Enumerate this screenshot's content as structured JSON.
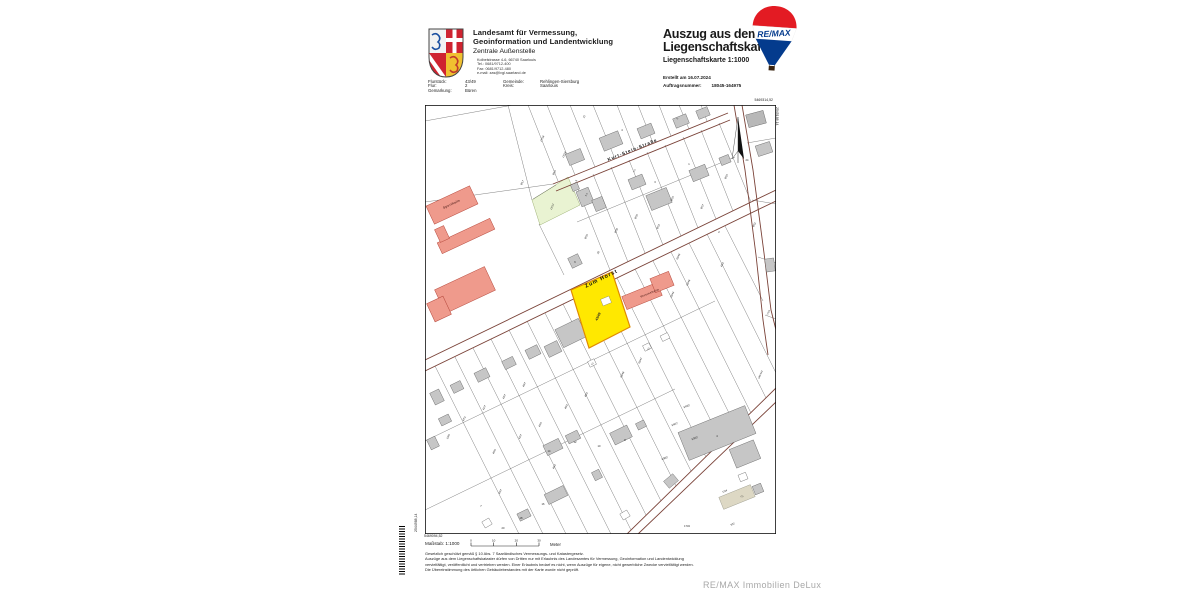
{
  "document": {
    "agency": {
      "name_line1": "Landesamt für Vermessung,",
      "name_line2": "Geoinformation und Landentwicklung",
      "office": "Zentrale Außenstelle",
      "address_lines": [
        "Kolbelstrasse 4-6, 66740 Saarlouis",
        "Tel.: 0681/9712-400",
        "Fax: 0681/9712-480",
        "e-mail: zas@lvgl.saarland.de"
      ]
    },
    "parcel_info": {
      "flurstueck_label": "Flurstück:",
      "flurstueck": "43/49",
      "flur_label": "Flur:",
      "flur": "2",
      "gemarkung_label": "Gemarkung:",
      "gemarkung": "Büren",
      "gemeinde_label": "Gemeinde:",
      "gemeinde": "Rehlingen-Siersburg",
      "kreis_label": "Kreis:",
      "kreis": "Saarlouis"
    },
    "title": {
      "line1": "Auszug aus dem",
      "line2": "Liegenschaftskataster",
      "subtitle": "Liegenschaftskarte  1:1000",
      "created": "Erstellt am  16.07.2024",
      "order_label": "Auftragsnummer:",
      "order_number": "18045-164975"
    },
    "logo": {
      "brand": "RE/MAX",
      "red": "#e31b23",
      "blue": "#043b8d"
    }
  },
  "map": {
    "corner_coordinates": {
      "north_top": "5469314,52",
      "east_right": "2545188,14",
      "west_left": "2544988,14",
      "north_bottom": "5469094,52"
    },
    "street_labels": [
      {
        "t": "Kurt-Stein-Straße",
        "x": 208,
        "y": 46,
        "r": -22,
        "s": 4.4
      },
      {
        "t": "Zum Horst",
        "x": 177,
        "y": 175,
        "r": -26,
        "s": 5.4
      }
    ],
    "area_labels": [
      {
        "t": "Sporthalle",
        "x": 27,
        "y": 100,
        "r": -25,
        "s": 3.2
      },
      {
        "t": "Vereinsheim",
        "x": 225,
        "y": 189,
        "r": -22,
        "s": 2.9
      }
    ],
    "subject_parcel": {
      "t": "43/49",
      "x": 174,
      "y": 212,
      "r": -65,
      "s": 3.4
    },
    "parcel_labels": [
      {
        "t": "17/18",
        "x": 118,
        "y": 34,
        "r": -65
      },
      {
        "t": "12/18",
        "x": 140,
        "y": 50,
        "r": -65
      },
      {
        "t": "8/19",
        "x": 130,
        "y": 68,
        "r": -65
      },
      {
        "t": "22",
        "x": 160,
        "y": 12,
        "r": -65
      },
      {
        "t": "4",
        "x": 197,
        "y": 26,
        "r": 0
      },
      {
        "t": "2",
        "x": 253,
        "y": 14,
        "r": -65
      },
      {
        "t": "6",
        "x": 152,
        "y": 76,
        "r": -65
      },
      {
        "t": "8/17",
        "x": 98,
        "y": 78,
        "r": -65
      },
      {
        "t": "12/17",
        "x": 128,
        "y": 102,
        "r": -65
      },
      {
        "t": "5 a",
        "x": 162,
        "y": 90,
        "r": -65,
        "s": 2.3
      },
      {
        "t": "1 b",
        "x": 210,
        "y": 66,
        "r": -65,
        "s": 2.3
      },
      {
        "t": "3",
        "x": 230,
        "y": 78,
        "r": 0
      },
      {
        "t": "1",
        "x": 264,
        "y": 60,
        "r": 0
      },
      {
        "t": "8/24",
        "x": 248,
        "y": 94,
        "r": -65
      },
      {
        "t": "8/34",
        "x": 302,
        "y": 72,
        "r": -65
      },
      {
        "t": "8/20",
        "x": 212,
        "y": 112,
        "r": -65
      },
      {
        "t": "8/28",
        "x": 192,
        "y": 126,
        "r": -65
      },
      {
        "t": "8/23",
        "x": 234,
        "y": 122,
        "r": -65
      },
      {
        "t": "8/27",
        "x": 278,
        "y": 102,
        "r": -65
      },
      {
        "t": "2",
        "x": 294,
        "y": 128,
        "r": 0
      },
      {
        "t": "8/29",
        "x": 162,
        "y": 132,
        "r": -65
      },
      {
        "t": "28",
        "x": 174,
        "y": 148,
        "r": -65
      },
      {
        "t": "6",
        "x": 150,
        "y": 158,
        "r": 0
      },
      {
        "t": "43/45",
        "x": 254,
        "y": 152,
        "r": -65
      },
      {
        "t": "43/46",
        "x": 264,
        "y": 178,
        "r": -65
      },
      {
        "t": "43/44",
        "x": 248,
        "y": 190,
        "r": -65
      },
      {
        "t": "43/2",
        "x": 298,
        "y": 160,
        "r": -65
      },
      {
        "t": "(1)",
        "x": 168,
        "y": 259,
        "r": -65,
        "s": 2.2
      },
      {
        "t": "(1)",
        "x": 224,
        "y": 244,
        "r": -65,
        "s": 2.2
      },
      {
        "t": "43/47",
        "x": 216,
        "y": 256,
        "r": -65
      },
      {
        "t": "43/48",
        "x": 198,
        "y": 270,
        "r": -65
      },
      {
        "t": "45/7",
        "x": 100,
        "y": 280,
        "r": -65
      },
      {
        "t": "43/7",
        "x": 80,
        "y": 292,
        "r": -65
      },
      {
        "t": "41/7",
        "x": 60,
        "y": 303,
        "r": -65
      },
      {
        "t": "47/1",
        "x": 40,
        "y": 314,
        "r": -65
      },
      {
        "t": "15/9",
        "x": 24,
        "y": 332,
        "r": -65
      },
      {
        "t": "44/4",
        "x": 116,
        "y": 320,
        "r": -65
      },
      {
        "t": "42/7",
        "x": 96,
        "y": 332,
        "r": -65
      },
      {
        "t": "40/9",
        "x": 70,
        "y": 347,
        "r": -65
      },
      {
        "t": "46/2",
        "x": 142,
        "y": 302,
        "r": -65
      },
      {
        "t": "48/2",
        "x": 162,
        "y": 290,
        "r": -65
      },
      {
        "t": "49/2",
        "x": 130,
        "y": 362,
        "r": -65
      },
      {
        "t": "44/7",
        "x": 76,
        "y": 387,
        "r": -65
      },
      {
        "t": "7",
        "x": 56,
        "y": 402,
        "r": 0
      },
      {
        "t": "10",
        "x": 174,
        "y": 342,
        "r": 0
      },
      {
        "t": "8",
        "x": 200,
        "y": 336,
        "r": 0
      },
      {
        "t": "14",
        "x": 124,
        "y": 347,
        "r": 0
      },
      {
        "t": "12",
        "x": 150,
        "y": 338,
        "r": 0
      },
      {
        "t": "16",
        "x": 118,
        "y": 400,
        "r": 0
      },
      {
        "t": "18",
        "x": 96,
        "y": 414,
        "r": 0
      },
      {
        "t": "20",
        "x": 78,
        "y": 424,
        "r": 0
      },
      {
        "t": "543/2",
        "x": 262,
        "y": 302,
        "r": -22
      },
      {
        "t": "540/7",
        "x": 250,
        "y": 320,
        "r": -22
      },
      {
        "t": "539/2",
        "x": 270,
        "y": 334,
        "r": -22
      },
      {
        "t": "538/2",
        "x": 240,
        "y": 354,
        "r": -22
      },
      {
        "t": "1001/542",
        "x": 336,
        "y": 270,
        "r": -65,
        "s": 2.2
      },
      {
        "t": "4",
        "x": 292,
        "y": 332,
        "r": 0
      },
      {
        "t": "1/34",
        "x": 300,
        "y": 387,
        "r": -22
      },
      {
        "t": "(1)",
        "x": 317,
        "y": 392,
        "r": 0,
        "s": 2.2
      },
      {
        "t": "537",
        "x": 308,
        "y": 420,
        "r": -22
      },
      {
        "t": "1734",
        "x": 262,
        "y": 422,
        "r": 0
      },
      {
        "t": "173/3",
        "x": 344,
        "y": 208,
        "r": -65,
        "s": 2.2
      },
      {
        "t": "8/31",
        "x": 330,
        "y": 120,
        "r": -65
      },
      {
        "t": "24",
        "x": 322,
        "y": 56,
        "r": 0
      }
    ]
  },
  "footer": {
    "scale_label": "Maßstab:  1:1000",
    "scale_unit": "Meter",
    "scale_ticks": [
      "0",
      "10",
      "20",
      "30"
    ],
    "legal_lines": [
      "Gesetzlich geschützt gemäß § 10 Abs. 7 Saarländisches Vermessungs- und Katastergesetz.",
      "Auszüge aus dem Liegenschaftskataster dürfen von Dritten nur mit Erlaubnis des Landesamtes für Vermessung, Geoinformation und Landentwicklung",
      "vervielfältigt, veröffentlicht und vertrieben werden. Einer Erlaubnis bedarf es nicht, wenn Auszüge für eigene, nicht gewerbliche Zwecke vervielfältigt werden.",
      "Die Übereinstimmung des örtlichen Gebäudebestandes mit der Karte wurde nicht geprüft."
    ],
    "watermark": "RE/MAX Immobilien DeLux"
  }
}
